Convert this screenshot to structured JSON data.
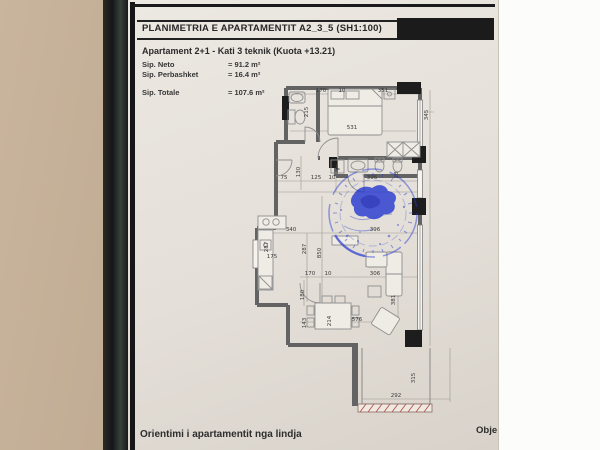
{
  "photo": {
    "background_left_color": "#bba68e",
    "edge_strip_color": "#14161a",
    "background_right_color": "#fcfcfb",
    "paper_color": "#e4dfd8"
  },
  "document": {
    "header": {
      "title": "PLANIMETRIA E APARTAMENTIT A2_3_5  (SH1:100)"
    },
    "info": {
      "title_line": "Apartament 2+1  - Kati 3 teknik (Kuota +13.21)",
      "rows": [
        {
          "label": "Sip. Neto",
          "value": "= 91.2 m²"
        },
        {
          "label": "Sip. Perbashket",
          "value": "= 16.4 m²"
        },
        {
          "label": "Sip. Totale",
          "value": "= 107.6 m²"
        }
      ]
    },
    "plan": {
      "room_label_laundry": "L",
      "stamp_color": "#2639cf",
      "wall_color": "#636363",
      "column_color": "#1d1d1d",
      "hatch_color": "#b2564f",
      "dimensions": [
        {
          "t": "170",
          "x": 321,
          "y": 92
        },
        {
          "t": "10",
          "x": 342,
          "y": 92
        },
        {
          "t": "351",
          "x": 383,
          "y": 92
        },
        {
          "t": "215",
          "x": 308,
          "y": 112,
          "r": -90
        },
        {
          "t": "345",
          "x": 428,
          "y": 115,
          "r": -90
        },
        {
          "t": "531",
          "x": 352,
          "y": 129
        },
        {
          "t": "130",
          "x": 300,
          "y": 172,
          "r": -90
        },
        {
          "t": "75",
          "x": 284,
          "y": 179
        },
        {
          "t": "125",
          "x": 316,
          "y": 179
        },
        {
          "t": "10",
          "x": 332,
          "y": 179
        },
        {
          "t": "396",
          "x": 372,
          "y": 179
        },
        {
          "t": "28",
          "x": 398,
          "y": 175,
          "r": -90
        },
        {
          "t": "340",
          "x": 291,
          "y": 231
        },
        {
          "t": "287",
          "x": 268,
          "y": 247,
          "r": -90
        },
        {
          "t": "287",
          "x": 306,
          "y": 249,
          "r": -90
        },
        {
          "t": "850",
          "x": 321,
          "y": 253,
          "r": -90
        },
        {
          "t": "175",
          "x": 272,
          "y": 258
        },
        {
          "t": "396",
          "x": 375,
          "y": 231
        },
        {
          "t": "170",
          "x": 310,
          "y": 275
        },
        {
          "t": "10",
          "x": 328,
          "y": 275
        },
        {
          "t": "180",
          "x": 304,
          "y": 295,
          "r": -90
        },
        {
          "t": "306",
          "x": 375,
          "y": 275
        },
        {
          "t": "381",
          "x": 395,
          "y": 300,
          "r": -90
        },
        {
          "t": "143",
          "x": 306,
          "y": 323,
          "r": -90
        },
        {
          "t": "214",
          "x": 331,
          "y": 321,
          "r": -90
        },
        {
          "t": "576",
          "x": 357,
          "y": 321
        },
        {
          "t": "315",
          "x": 415,
          "y": 378,
          "r": -90
        },
        {
          "t": "292",
          "x": 396,
          "y": 397
        }
      ]
    },
    "footer": {
      "left": "Orientimi i apartamentit nga lindja",
      "right_clipped": "Obje"
    }
  }
}
